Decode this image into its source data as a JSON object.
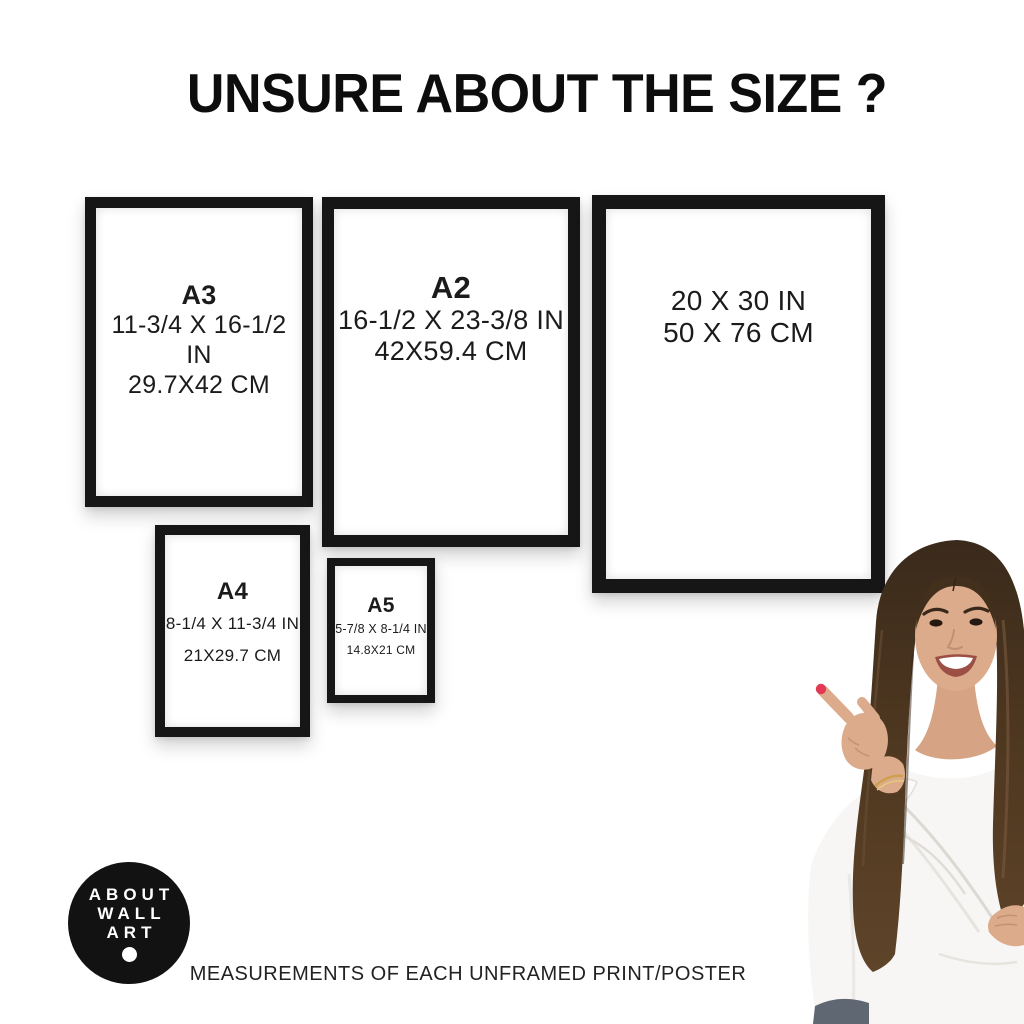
{
  "title": "UNSURE ABOUT THE SIZE ?",
  "frames": [
    {
      "id": "a3",
      "label": "A3",
      "inches": "11-3/4 X 16-1/2 IN",
      "cm": "29.7X42 CM"
    },
    {
      "id": "a2",
      "label": "A2",
      "inches": "16-1/2 X 23-3/8 IN",
      "cm": "42X59.4 CM"
    },
    {
      "id": "20x30",
      "label": "",
      "inches": "20 X 30 IN",
      "cm": "50 X 76 CM"
    },
    {
      "id": "a4",
      "label": "A4",
      "inches": "8-1/4 X 11-3/4 IN",
      "cm": "21X29.7 CM"
    },
    {
      "id": "a5",
      "label": "A5",
      "inches": "5-7/8 X 8-1/4 IN",
      "cm": "14.8X21 CM"
    }
  ],
  "logo": {
    "line1": "ABOUT",
    "line2": "WALL",
    "line3": "ART"
  },
  "footer": "MEASUREMENTS OF EACH UNFRAMED PRINT/POSTER",
  "colors": {
    "frame_black": "#161616",
    "logo_black": "#121212",
    "background": "#ffffff",
    "nail_red": "#e23a55"
  }
}
